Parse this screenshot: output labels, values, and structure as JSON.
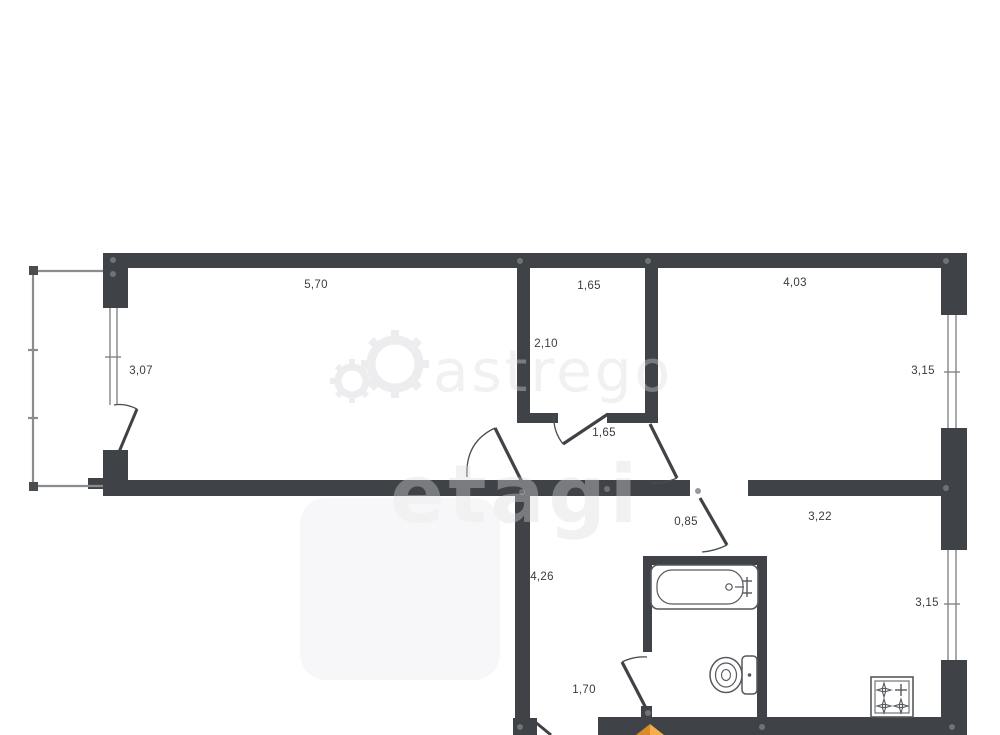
{
  "meta": {
    "document_type": "apartment floor plan",
    "unit": "meters"
  },
  "watermarks": {
    "brand_text": "astrego",
    "agency_text": "etagi"
  },
  "dimensions": {
    "living_width": "5,70",
    "living_depth": "3,07",
    "storage_width": "1,65",
    "storage_depth": "2,10",
    "bedroom_width": "4,03",
    "bedroom_depth": "3,15",
    "hall_passage": "1,65",
    "kitchen_passage": "0,85",
    "kitchen_width": "3,22",
    "kitchen_depth": "3,15",
    "corridor_length": "4,26",
    "corridor_width": "1,70"
  },
  "fixtures": {
    "bathtub": "bathtub-icon",
    "toilet": "toilet-icon",
    "stove": "stove-icon",
    "compass": "compass-north-arrow"
  },
  "colors": {
    "wall": "#3f4347",
    "thin_line": "#555a5e",
    "dimension_text": "#3b3b3d",
    "watermark": "#ebebed",
    "compass_orange": "#f0a23c"
  }
}
